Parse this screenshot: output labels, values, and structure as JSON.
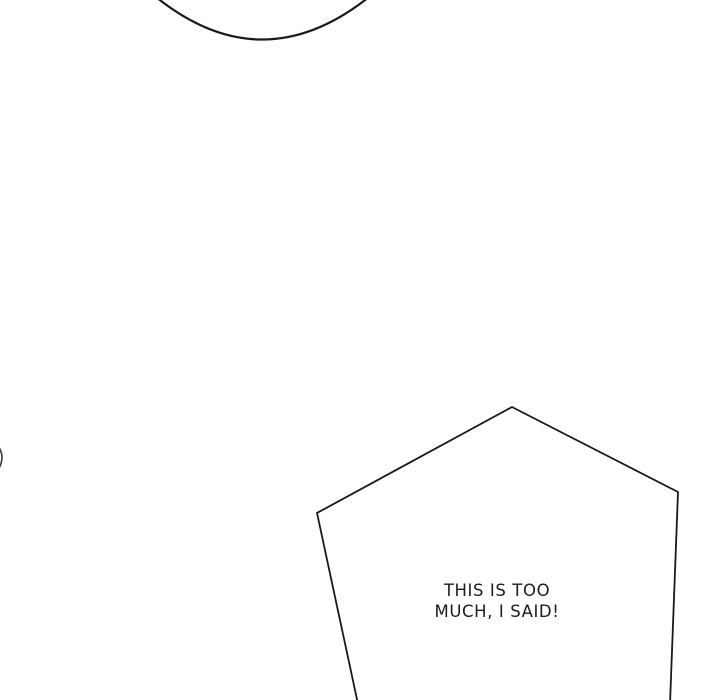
{
  "page": {
    "background_color": "#ffffff",
    "line_color": "#1a1a1a",
    "text_color": "#1c1c1c"
  },
  "top_bubble": {
    "description": "bottom arc of a speech bubble cropped by top edge"
  },
  "speech_bubble": {
    "shape": "pentagon",
    "text_line1": "THIS IS TOO",
    "text_line2": "MUCH, I SAID!"
  }
}
